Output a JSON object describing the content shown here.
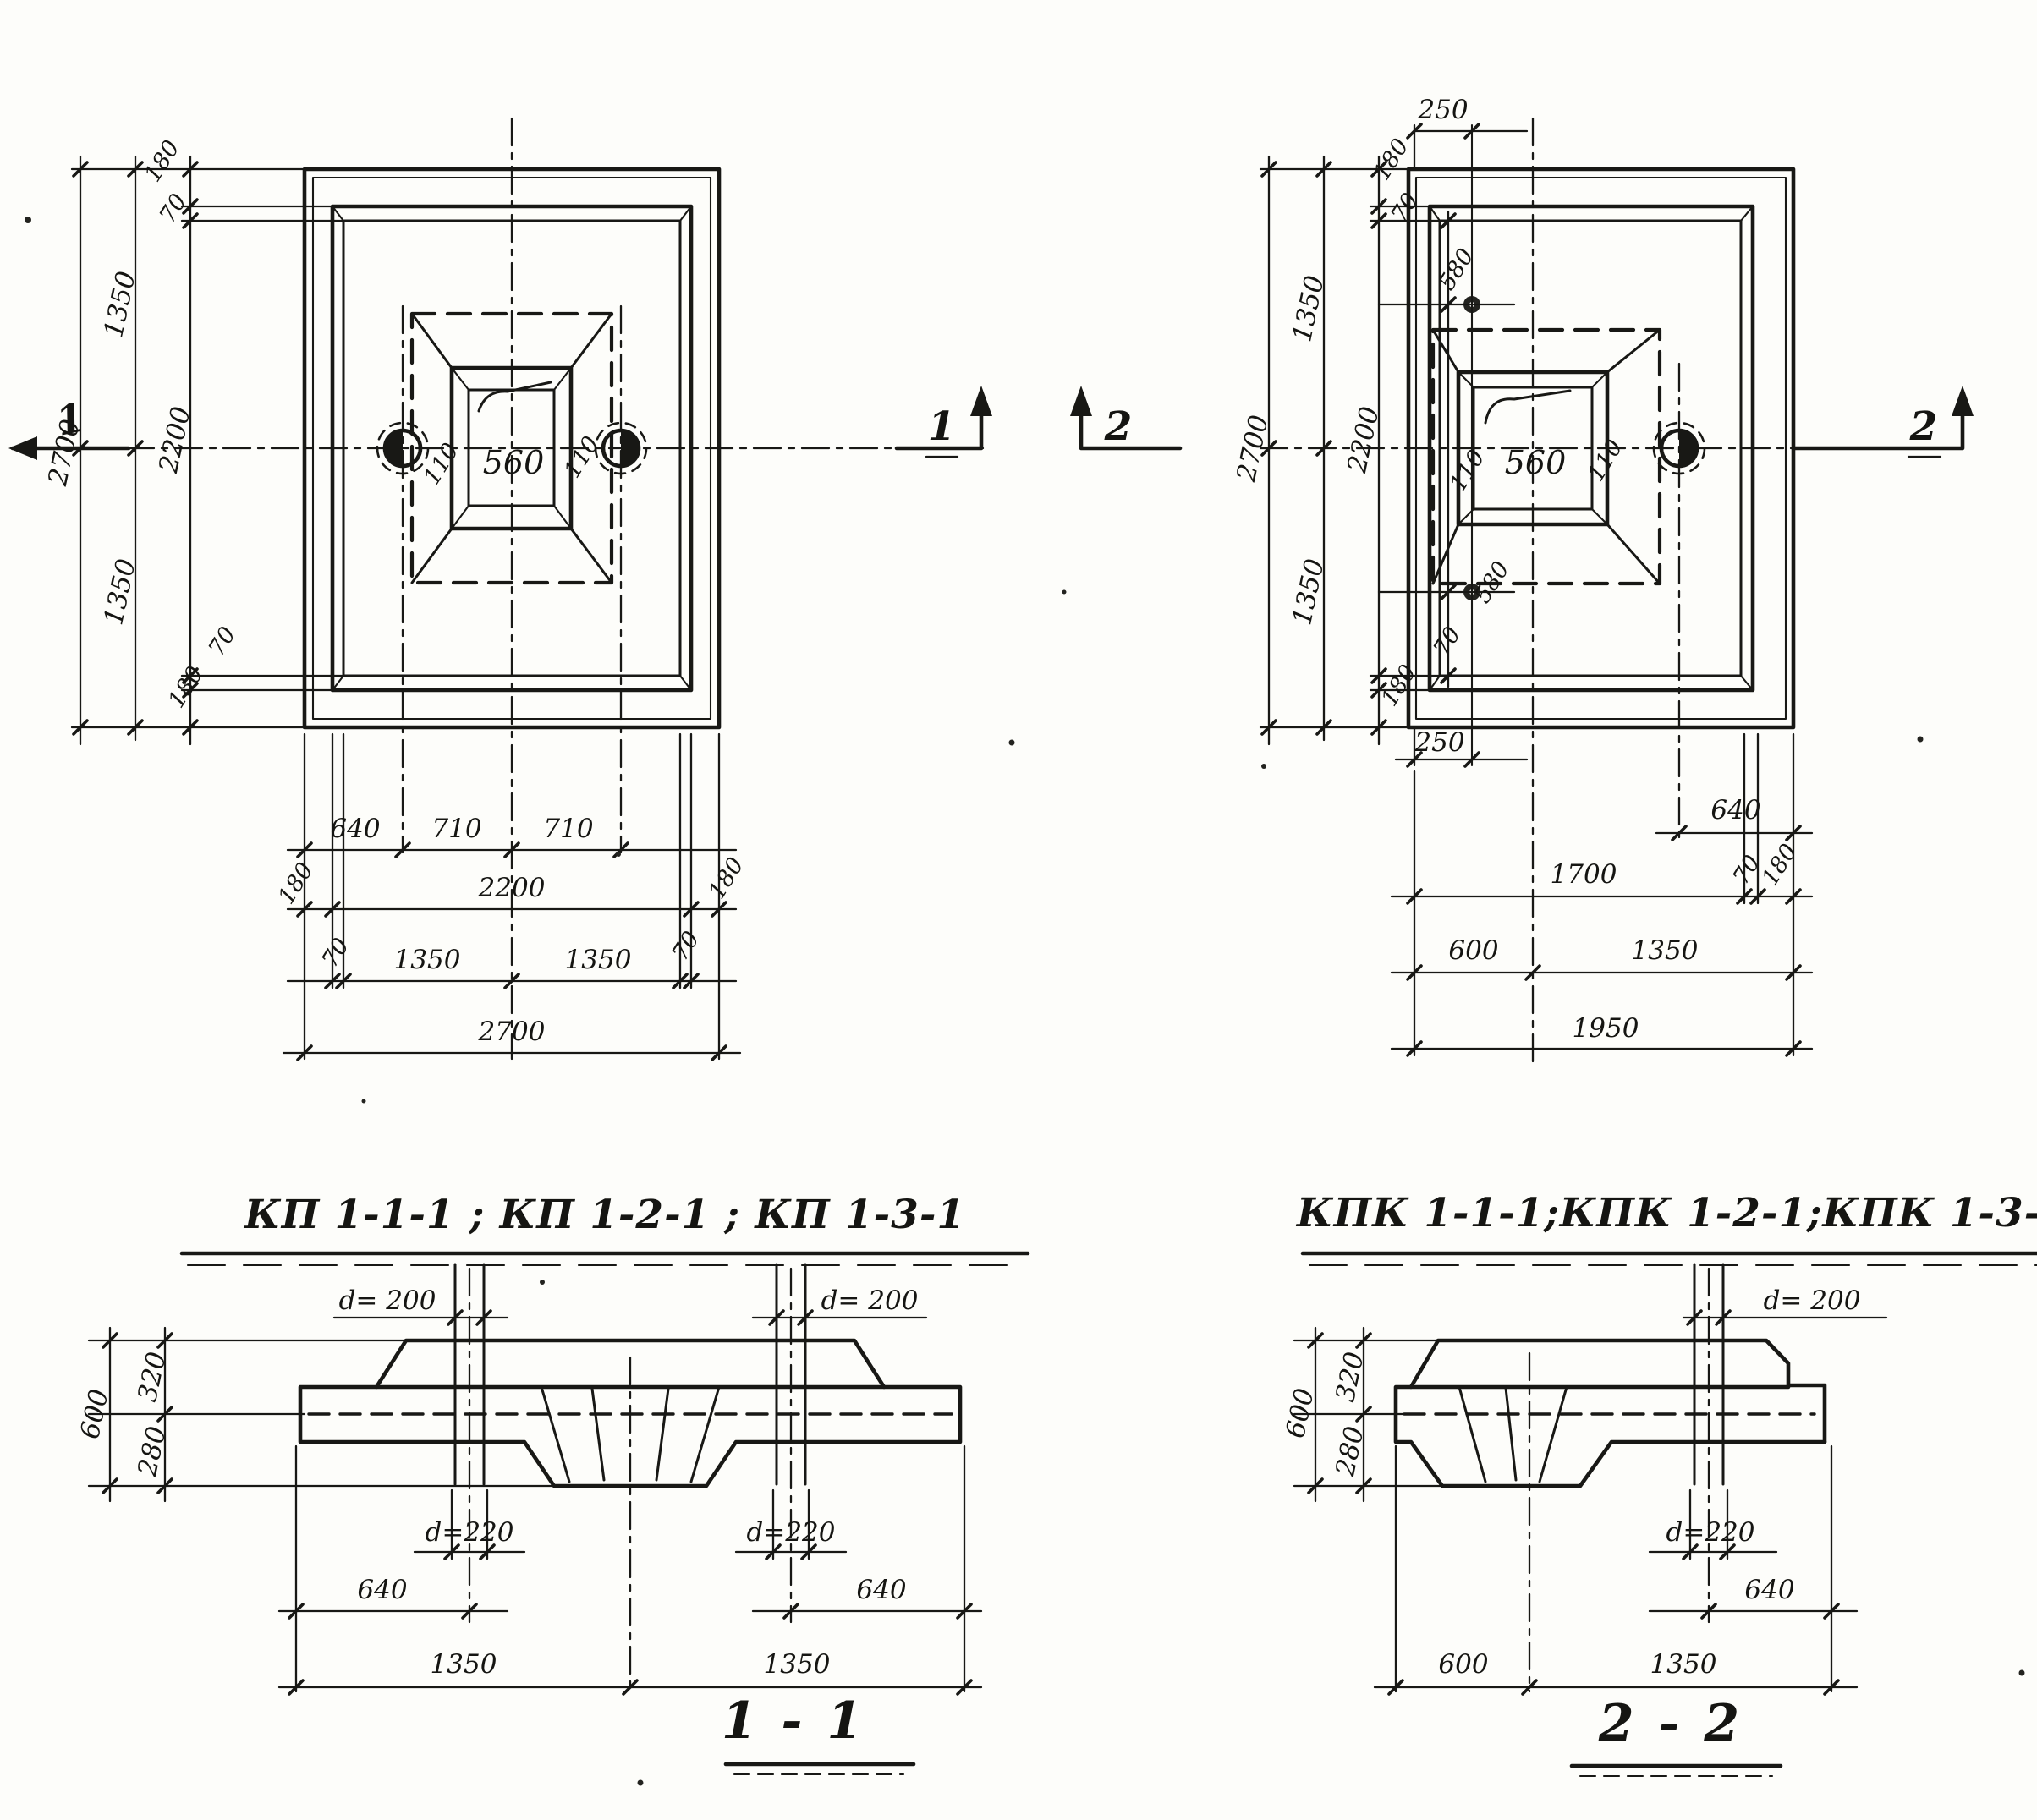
{
  "plan_left": {
    "title": "КП 1-1-1 ; КП 1-2-1 ; КП 1-3-1",
    "marker_left": "1",
    "marker_right": "1",
    "col_total": "2700",
    "col_half_top": "1350",
    "col_half_bot": "1350",
    "col_inner": "2200",
    "col_edge_top": "180",
    "col_lip_top": "70",
    "col_lip_bot": "70",
    "col_edge_bot": "180",
    "center_left": "110",
    "center_mid": "560",
    "center_right": "110",
    "row1": [
      "640",
      "710",
      "710"
    ],
    "row2": [
      "180",
      "2200",
      "180"
    ],
    "row3": [
      "70",
      "1350",
      "1350",
      "70"
    ],
    "row4": "2700"
  },
  "plan_right": {
    "title": "КПК 1-1-1;КПК 1-2-1;КПК 1-3-1",
    "marker_left": "2",
    "marker_right": "2",
    "top_dim": "250",
    "bottom_dim": "250",
    "col_total": "2700",
    "col_half_top": "1350",
    "col_half_bot": "1350",
    "col_inner": "2200",
    "edge_top": "180",
    "lip_top": "70",
    "hole_top": "580",
    "hole_bot": "580",
    "lip_bot": "70",
    "edge_bot": "180",
    "center_left": "110",
    "center_mid": "560",
    "center_right": "110",
    "row1": "640",
    "row2": [
      "1700",
      "70",
      "180"
    ],
    "row3": [
      "600",
      "1350"
    ],
    "row4": "1950"
  },
  "section_1": {
    "title": "1 - 1",
    "d_top_left": "d= 200",
    "d_top_right": "d= 200",
    "d_bot_left": "d=220",
    "d_bot_right": "d=220",
    "h_total": "600",
    "h_top": "320",
    "h_bot": "280",
    "off_left": "640",
    "off_right": "640",
    "half_left": "1350",
    "half_right": "1350"
  },
  "section_2": {
    "title": "2 - 2",
    "d_top": "d= 200",
    "d_bot": "d=220",
    "h_total": "600",
    "h_top": "320",
    "h_bot": "280",
    "off": "640",
    "w_left": "600",
    "w_right": "1350"
  }
}
